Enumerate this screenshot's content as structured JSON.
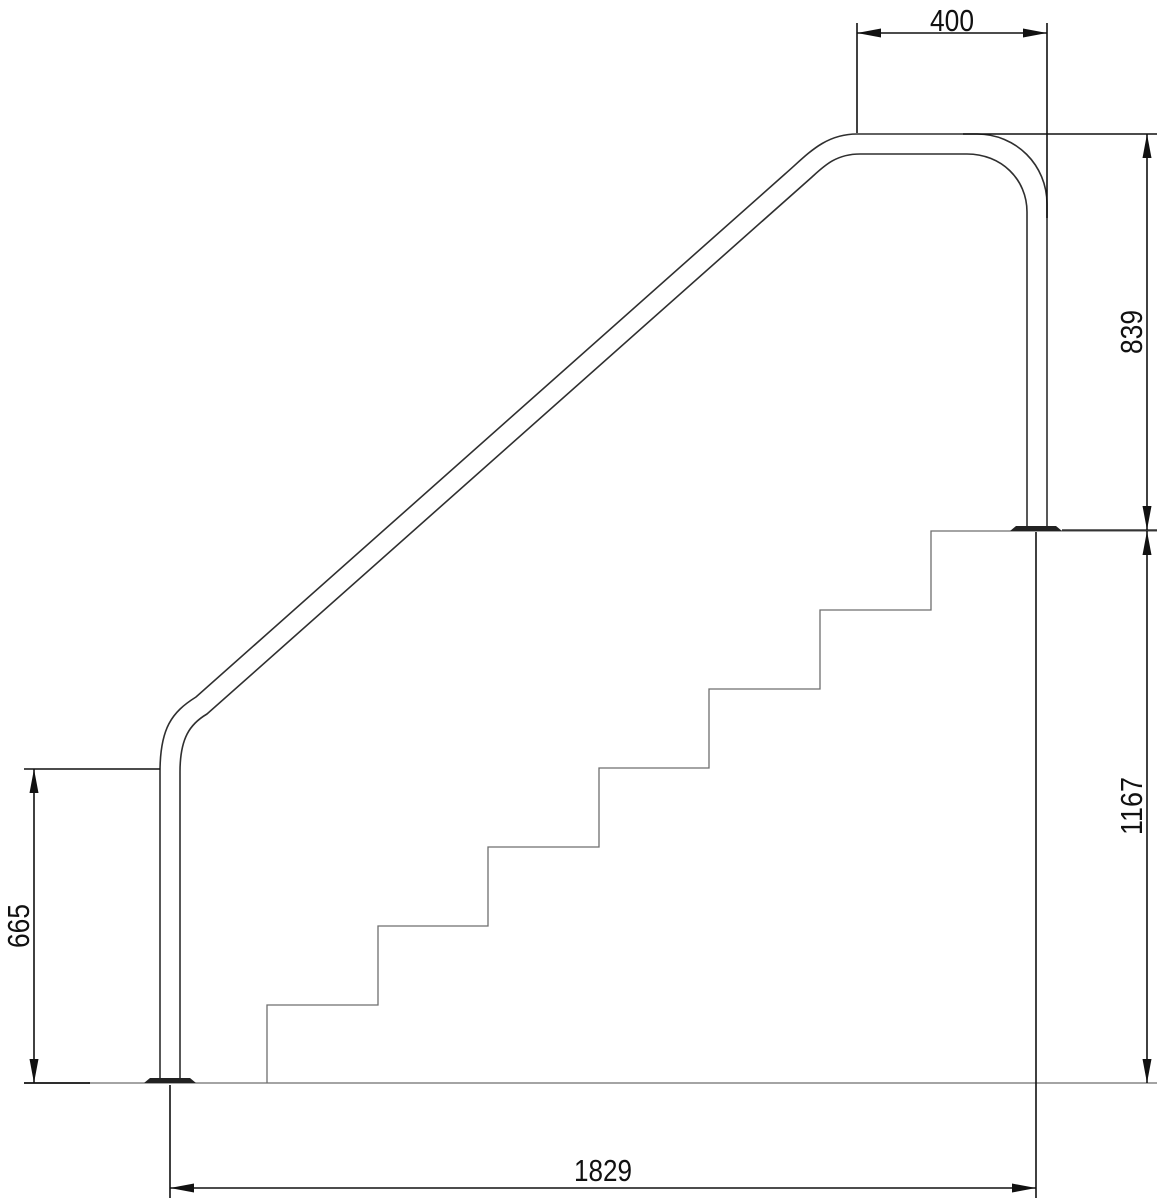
{
  "drawing": {
    "kind": "stair-handrail-side-elevation",
    "colors": {
      "background": "#ffffff",
      "dimension_lines": "#111111",
      "handrail_lines": "#2f2f2f",
      "stair_lines": "#6e6e6e",
      "flange_fill": "#222222"
    }
  },
  "dimensions": {
    "top_offset": {
      "value": "400",
      "orientation": "horizontal"
    },
    "upper_post_height": {
      "value": "839",
      "orientation": "vertical"
    },
    "platform_height": {
      "value": "1167",
      "orientation": "vertical"
    },
    "lower_rail_height": {
      "value": "665",
      "orientation": "vertical"
    },
    "overall_run": {
      "value": "1829",
      "orientation": "horizontal"
    }
  }
}
